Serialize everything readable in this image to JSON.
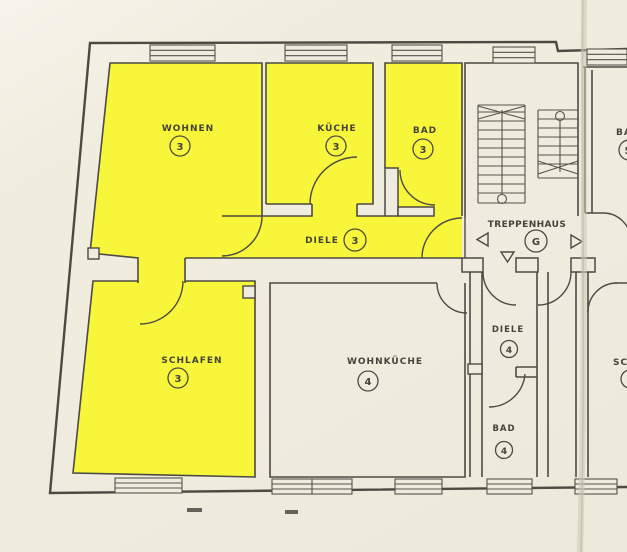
{
  "plan": {
    "title_hint": "apartment floor plan",
    "highlight_color": "#f8f63b",
    "paper_color": "#efecdf",
    "line_color": "#4b4a43",
    "rooms": {
      "wohnen": {
        "label": "WOHNEN",
        "number": "3"
      },
      "kueche": {
        "label": "KÜCHE",
        "number": "3"
      },
      "bad3": {
        "label": "BAD",
        "number": "3"
      },
      "diele3": {
        "label": "DIELE",
        "number": "3"
      },
      "treppenhaus": {
        "label": "TREPPENHAUS",
        "number": "G"
      },
      "schlafen": {
        "label": "SCHLAFEN",
        "number": "3"
      },
      "wohnkueche": {
        "label": "WOHNKÜCHE",
        "number": "4"
      },
      "diele4": {
        "label": "DIELE",
        "number": "4"
      },
      "bad4": {
        "label": "BAD",
        "number": "4"
      },
      "bad5_partial": {
        "label": "BA",
        "number": "5"
      },
      "schlafen5_partial": {
        "label": "SC"
      }
    }
  }
}
